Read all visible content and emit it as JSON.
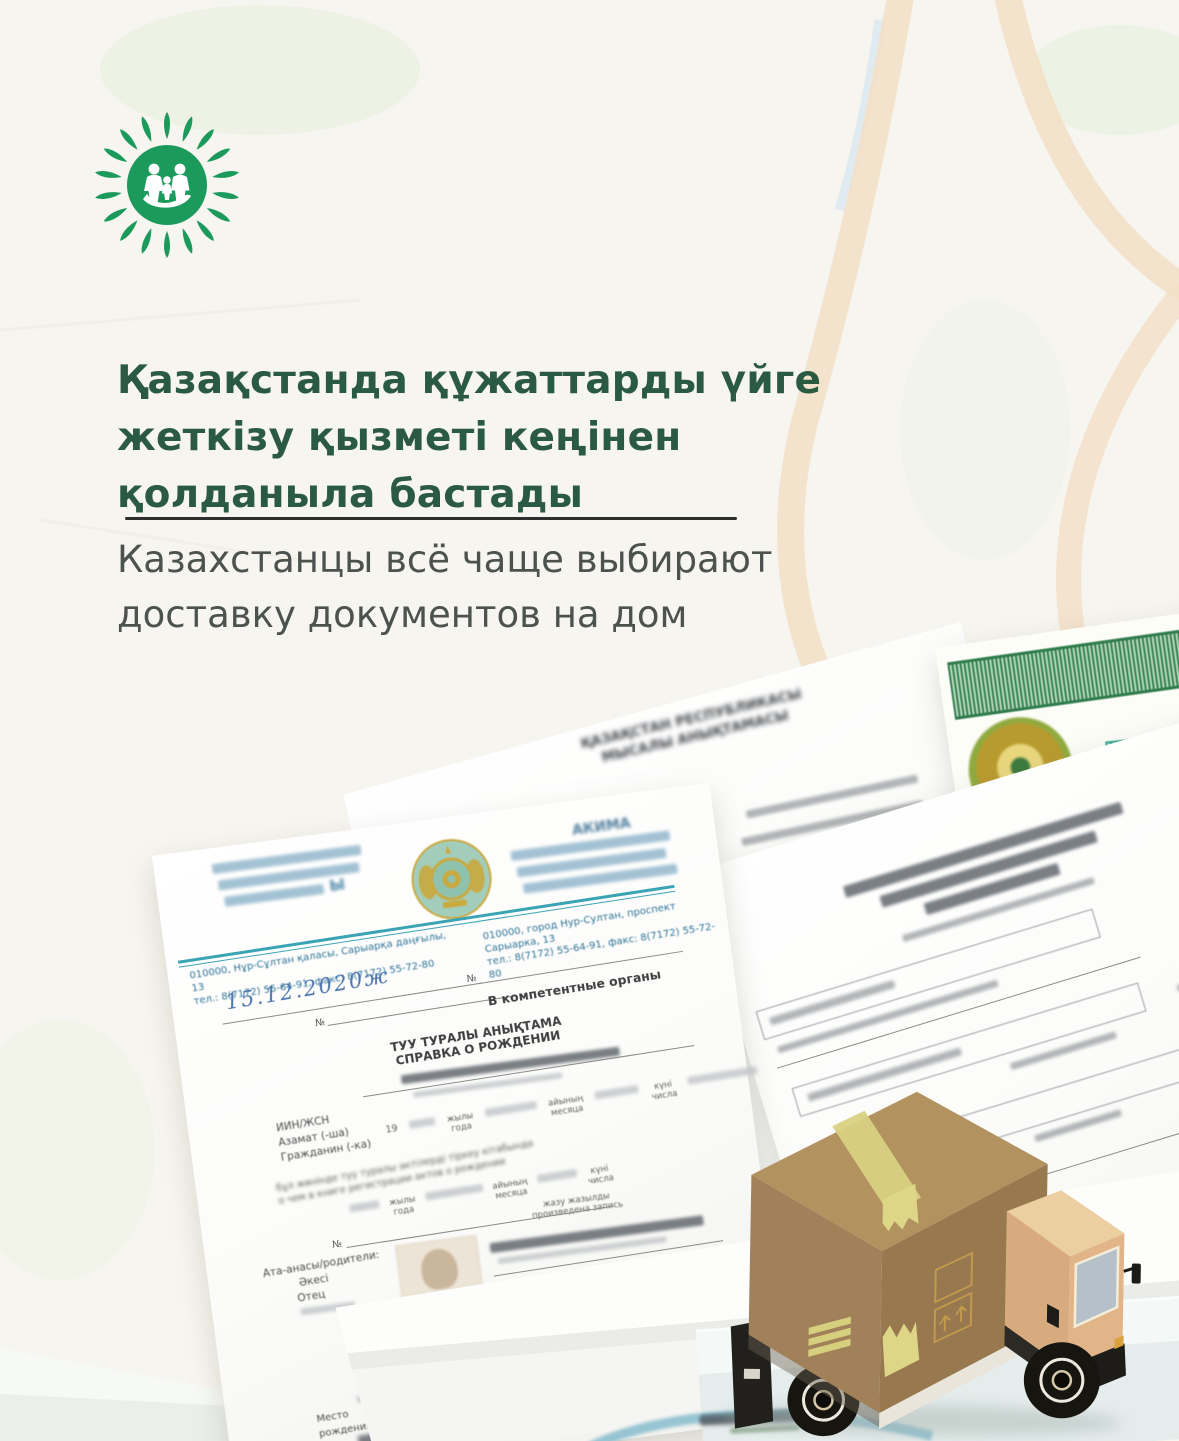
{
  "poster": {
    "brand_color": "#1b9a5c",
    "background_color": "#f7f5ef",
    "title": {
      "line1": "Қазақстанда құжаттарды үйге",
      "line2": "жеткізу қызметі кеңінен",
      "line3": "қолданыла бастады",
      "color": "#2b5a43"
    },
    "subtitle": {
      "line1": "Казахстанцы всё чаще выбирают",
      "line2": "доставку документов на дом",
      "color": "#4c524e"
    }
  },
  "background_document": {
    "heading_line1": "ҚАЗАҚСТАН РЕСПУБЛИКАСЫ",
    "heading_line2": "МЫСАЛЫ АНЫҚТАМАСЫ"
  },
  "letter_document": {
    "org_left_fragment": "Ы",
    "org_right_fragment": "АКИМА",
    "address_kk_line1": "010000, Нұр-Сұлтан қаласы, Сарыарқа даңғылы, 13",
    "address_kk_line2": "тел.: 8(7172) 55-64-91, факс: 8(7172) 55-72-80",
    "address_ru_line1": "010000, город Нур-Султан, проспект Сарыарка, 13",
    "address_ru_line2": "тел.: 8(7172) 55-64-91, факс: 8(7172) 55-72-80",
    "handwritten_date": "15.12.2020ж",
    "number_sign": "№",
    "addressee": "В компетентные органы",
    "form_title_kk": "ТУУ ТУРАЛЫ АНЫҚТАМА",
    "form_title_ru": "СПРАВКА О РОЖДЕНИИ",
    "label_iin": "ИИН/ЖСН",
    "label_citizen_kk": "Азамат (-ша)",
    "label_citizen_ru": "Гражданин (-ка)",
    "label_year_prefix": "19",
    "label_year_kk": "жылы",
    "label_year_ru": "года",
    "label_month_kk": "айының",
    "label_month_ru": "месяца",
    "label_day_kk": "күні",
    "label_day_ru": "числа",
    "note_kk": "бұл жөнінде туу туралы актілерді тіркеу кітабында",
    "note_ru": "о чем в книге регистрации актов о рождении",
    "record_kk": "жазу жазылды",
    "record_ru": "произведена запись",
    "label_parents": "Ата-анасы/родители:",
    "label_father_kk": "Әкесі",
    "label_father_ru": "Отец",
    "label_birthplace_line1": "Место",
    "label_birthplace_line2": "рождения"
  },
  "truck": {
    "box_color": "#a1815a",
    "cab_color": "#e2b588",
    "tape_color": "#d9d182"
  }
}
